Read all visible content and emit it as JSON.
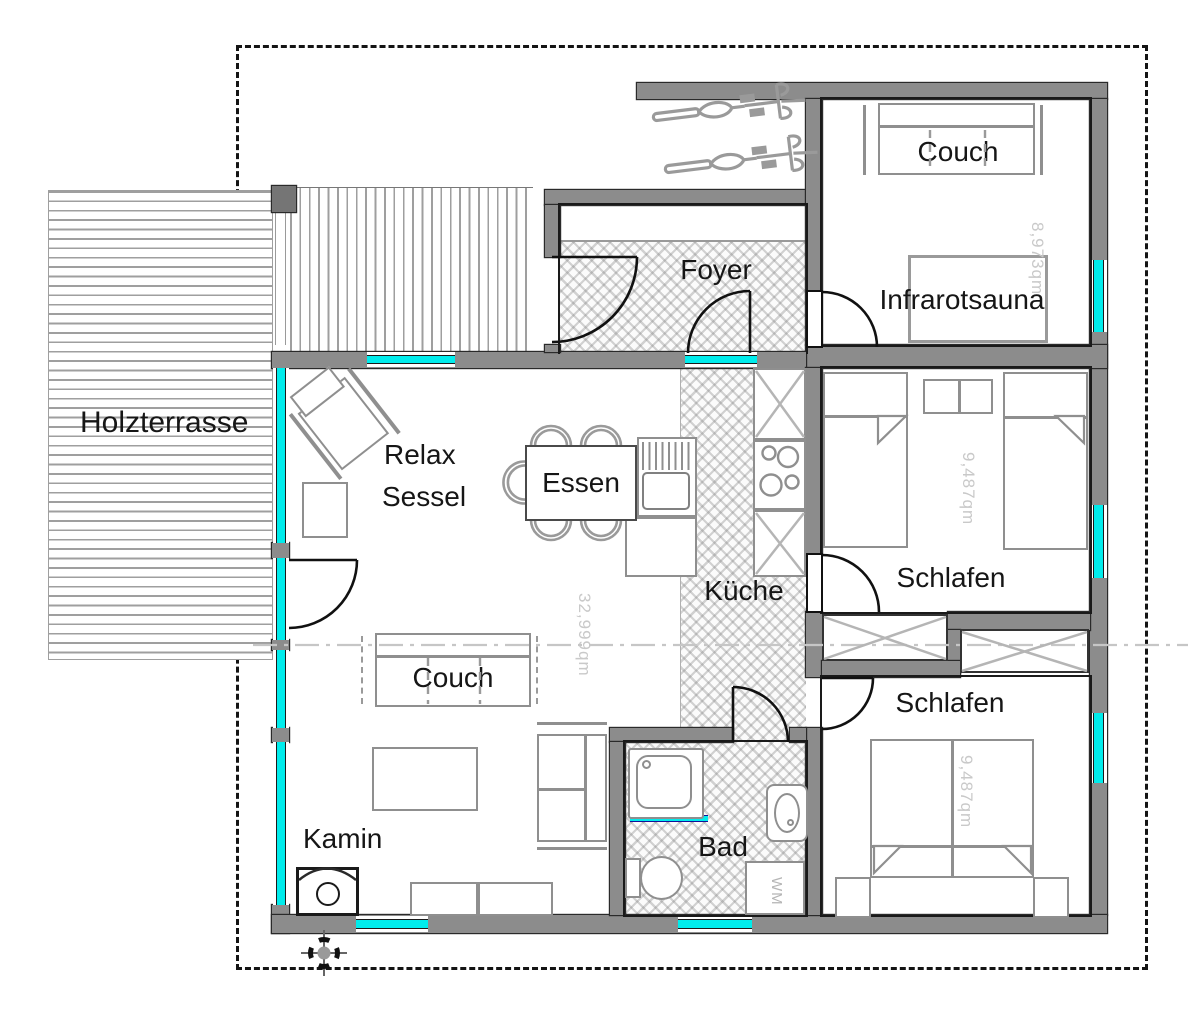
{
  "plan_type": "floorplan",
  "colors": {
    "wall": "#8c8c8c",
    "glass": "#00ECEC",
    "furniture_line": "#8f8f8f",
    "label": "#161616",
    "faint_label": "#c9c9c9"
  },
  "rooms": {
    "holzterrasse": {
      "label": "Holzterrasse"
    },
    "foyer": {
      "label": "Foyer"
    },
    "infrarotsauna": {
      "label": "Infrarotsauna",
      "area": "8,973qm",
      "couch": "Couch"
    },
    "wohnen": {
      "area": "32,999qm",
      "relax_line1": "Relax",
      "relax_line2": "Sessel",
      "essen": "Essen",
      "couch": "Couch",
      "kamin": "Kamin"
    },
    "kueche": {
      "label": "Küche"
    },
    "schlafen_oben": {
      "label": "Schlafen",
      "area": "9,487qm"
    },
    "schlafen_unten": {
      "label": "Schlafen",
      "area": "9,487qm"
    },
    "bad": {
      "label": "Bad",
      "wm": "WM"
    }
  }
}
